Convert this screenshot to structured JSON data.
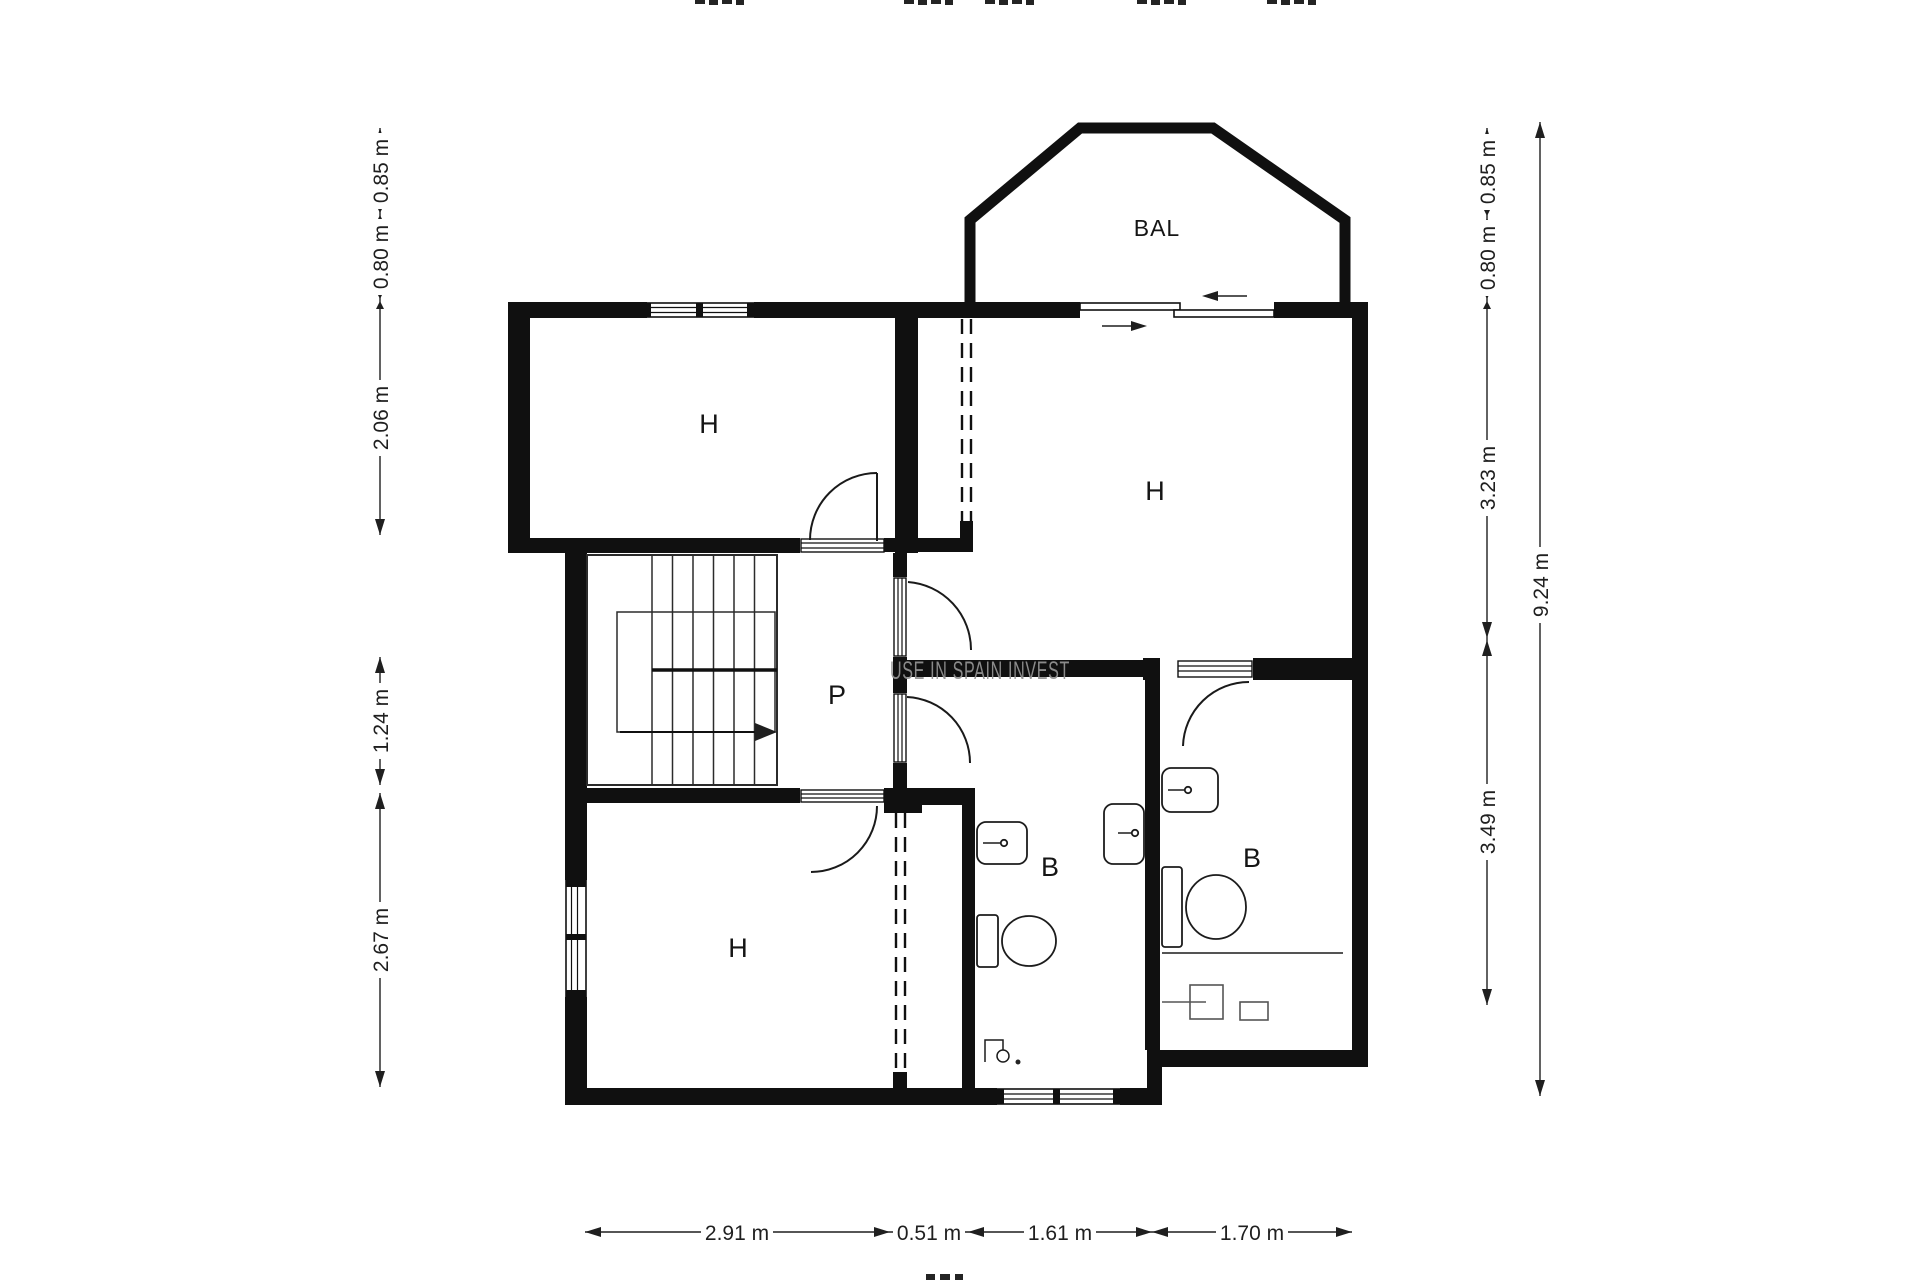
{
  "watermark": "USE IN SPAIN INVEST",
  "rooms": {
    "bedroom_top_left": "H",
    "bedroom_top_right": "H",
    "bedroom_bottom_left": "H",
    "hallway": "P",
    "bathroom_middle": "B",
    "bathroom_right": "B",
    "balcony": "BAL"
  },
  "dimensions": {
    "left": [
      "0.85 m",
      "0.80 m",
      "2.06 m",
      "1.24 m",
      "2.67 m"
    ],
    "right": [
      "0.85 m",
      "0.80 m",
      "3.23 m",
      "3.49 m"
    ],
    "right_overall": "9.24 m",
    "bottom": [
      "2.91 m",
      "0.51 m",
      "1.61 m",
      "1.70 m"
    ]
  }
}
